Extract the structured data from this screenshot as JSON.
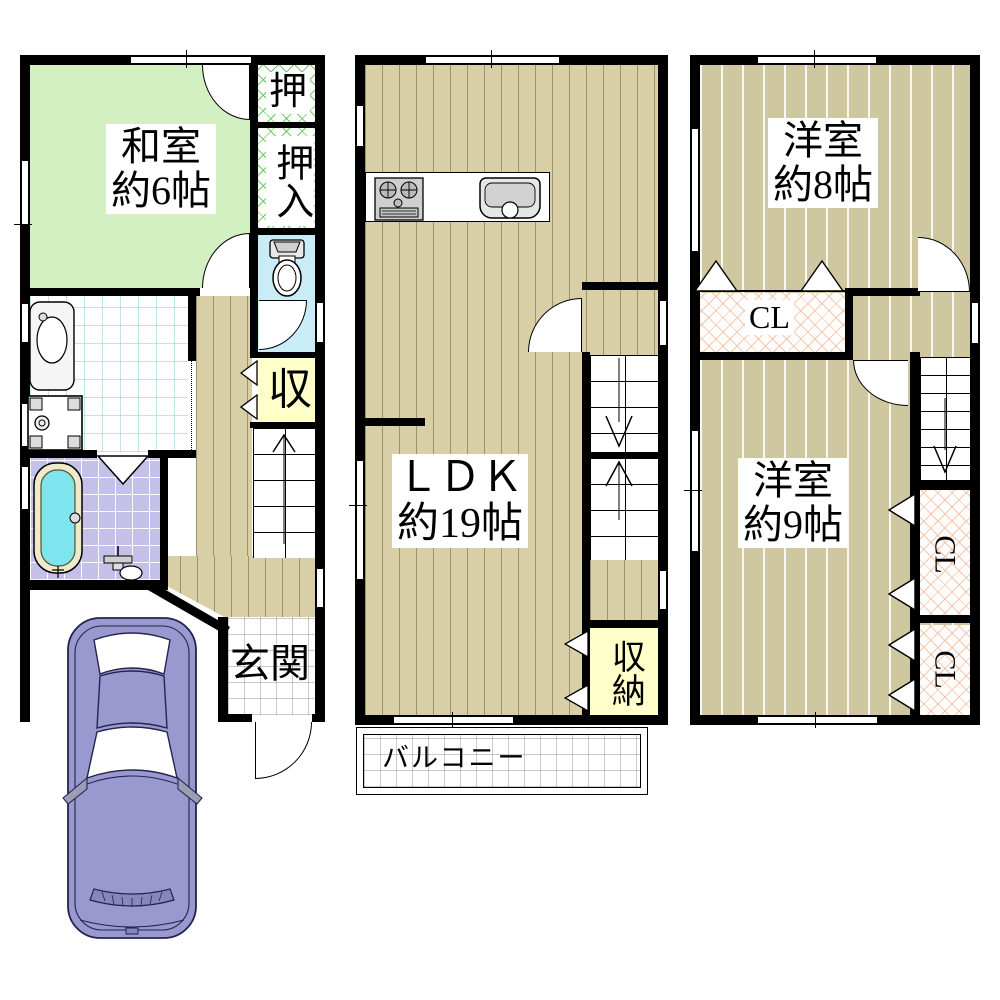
{
  "page_title": "間取り図",
  "colors": {
    "wall": "#000000",
    "tatami_green": "#d2f0c2",
    "wood_tan": "#d8cfa6",
    "wood_tan_light": "#cfc7a0",
    "closet_hatch_green": "#46b946",
    "closet_hatch_pink": "#eba073",
    "toilet_cyan": "#c9edf7",
    "bath_tile_purple": "#c4c0e8",
    "tub_water_cyan": "#7ee4ee",
    "storage_yellow": "#ffffc9",
    "car_body_purple": "#9a99cf"
  },
  "floor1": {
    "washitsu_line1": "和室",
    "washitsu_line2": "約6帖",
    "closet_upper": "押",
    "closet_lower": "押入",
    "storage": "収",
    "entrance": "玄関"
  },
  "floor2": {
    "ldk_line1": "ＬＤＫ",
    "ldk_line2": "約19帖",
    "storage": "収納",
    "balcony": "バルコニー"
  },
  "floor3": {
    "room8_line1": "洋室",
    "room8_line2": "約8帖",
    "closet_top": "CL",
    "room9_line1": "洋室",
    "room9_line2": "約9帖",
    "closet_upper_right": "CL",
    "closet_lower_right": "CL"
  }
}
